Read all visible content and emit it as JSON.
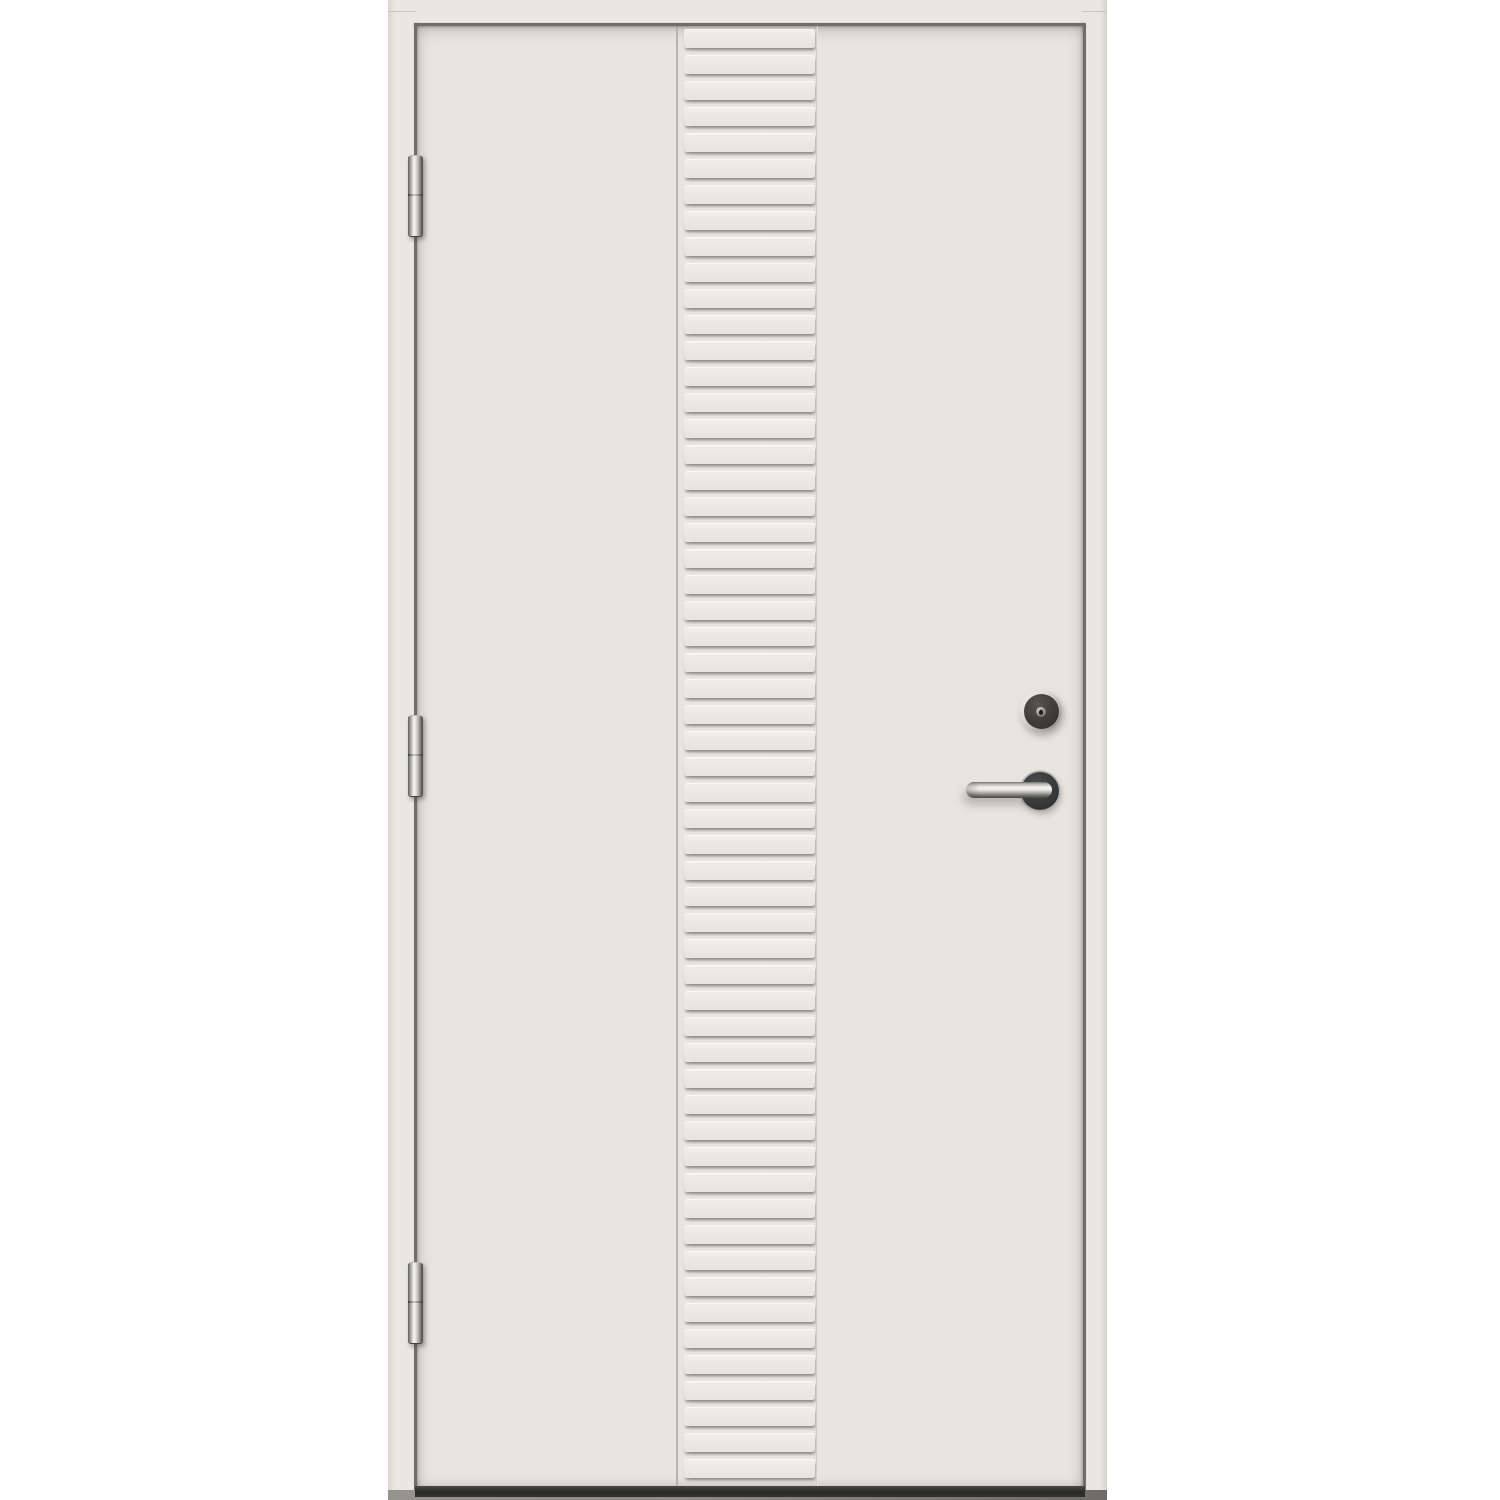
{
  "image": {
    "type": "product-photo",
    "subject": "White exterior door with vertical ribbed center panel, three barrel hinges on the left, lock cylinder and stainless lever handle on the right",
    "background_color": "#ffffff"
  },
  "door": {
    "frame": {
      "color": "#eae7e2",
      "edge_shadow_color": "#d5d2cd"
    },
    "leaf": {
      "color": "#e8e4df"
    },
    "reveal_gap_color": "#716e6a",
    "ribbed_panel": {
      "slat_count": 56,
      "slat_color": "#ece8e3",
      "slat_highlight": "#f2efea",
      "groove_shadow": "#aaa69f"
    },
    "hinges": {
      "count": 3,
      "finish": "brushed-steel",
      "highlight_color": "#f5f4f2",
      "shadow_color": "#4a4947"
    },
    "lock_cylinder": {
      "ring_color": "#d9d7d4",
      "face_color": "#3e3c39"
    },
    "handle": {
      "finish": "stainless-steel",
      "lever_highlight": "#f4f3f1",
      "rosette_color": "#38393b"
    },
    "threshold": {
      "bar_color": "#2a2927",
      "sill_color": "#8b8885"
    }
  }
}
